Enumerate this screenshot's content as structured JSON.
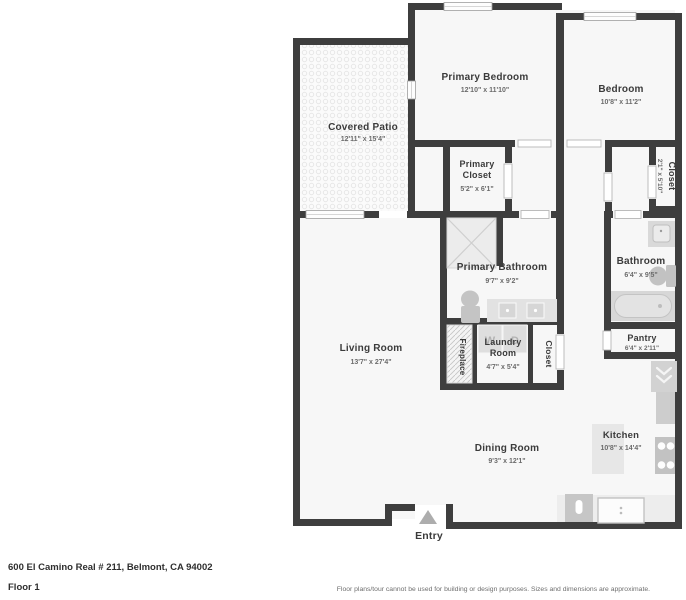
{
  "floorplan": {
    "colors": {
      "wall": "#3e3e3e",
      "floor": "#f7f7f7",
      "fixture": "#d2d2d2",
      "patio_dot": "#ececec"
    },
    "rooms": {
      "covered_patio": {
        "name": "Covered Patio",
        "dims": "12'11\" x 15'4\""
      },
      "primary_bedroom": {
        "name": "Primary Bedroom",
        "dims": "12'10\" x 11'10\""
      },
      "bedroom": {
        "name": "Bedroom",
        "dims": "10'8\" x 11'2\""
      },
      "primary_closet": {
        "name": "Primary Closet",
        "dims": "5'2\" x 6'1\""
      },
      "bedroom_closet": {
        "name": "Closet",
        "dims": "2'1\" x 5'10\""
      },
      "primary_bathroom": {
        "name": "Primary Bathroom",
        "dims": "9'7\" x 9'2\""
      },
      "bathroom": {
        "name": "Bathroom",
        "dims": "6'4\" x 9'5\""
      },
      "living_room": {
        "name": "Living Room",
        "dims": "13'7\" x 27'4\""
      },
      "fireplace": {
        "name": "Fireplace"
      },
      "laundry_room": {
        "name": "Laundry Room",
        "dims": "4'7\" x 5'4\""
      },
      "hall_closet": {
        "name": "Closet"
      },
      "pantry": {
        "name": "Pantry",
        "dims": "6'4\" x 2'11\""
      },
      "dining_room": {
        "name": "Dining Room",
        "dims": "9'3\" x 12'1\""
      },
      "kitchen": {
        "name": "Kitchen",
        "dims": "10'8\" x 14'4\""
      },
      "entry": {
        "name": "Entry"
      }
    },
    "appliances": {
      "washer": "W",
      "dryer": "D"
    }
  },
  "footer": {
    "address": "600 El Camino Real # 211, Belmont, CA 94002",
    "floor": "Floor 1",
    "disclaimer": "Floor plans/tour cannot be used for building or design purposes. Sizes and dimensions are approximate."
  }
}
